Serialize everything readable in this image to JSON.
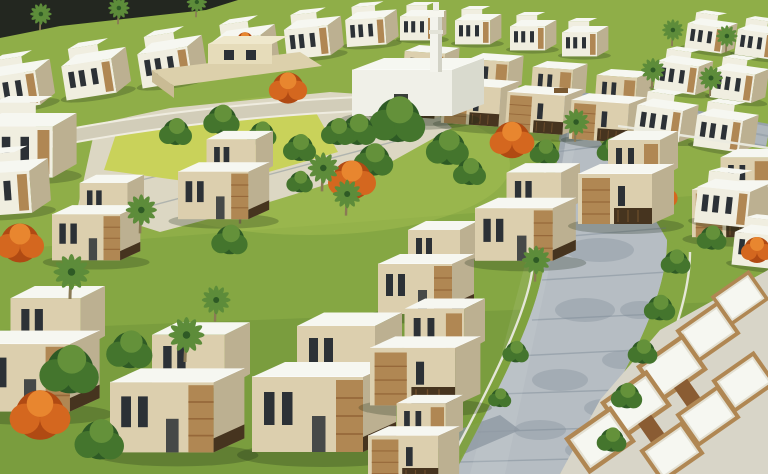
{
  "scene": {
    "type": "aerial architectural rendering",
    "description": "Aerial 3D rendering of a residential villa compound: parallel rows of white and beige flat-roofed villas with tan stone feature walls and dark timber pergolas, a central landscaped park with a yellow-green lawn, paved plaza, palm trees and orange flame trees, a white mosque with a tall minaret, a low clubhouse pavilion, and a curved grey paver street sweeping to the foreground.",
    "landmarks": {
      "mosque": "white mosque with tall minaret beside the central park",
      "clubhouse": "low beige pavilion at the top of the park lawn",
      "park": "central green park with lawn panel and pale paved plaza",
      "main_street": "curved grey paver street from upper right to bottom centre",
      "villa_rows": "receding rows of two-storey villas with white roof slabs"
    },
    "colors": {
      "grass": "#85a743",
      "grass_light": "#a3bd52",
      "lawn_yellow": "#c9d25a",
      "plaza_pale": "#dcd7c3",
      "dark_road": "#232720",
      "tree_dark": "#2e5a25",
      "tree_mid": "#44752d",
      "tree_light": "#64913a",
      "flame_deep": "#b04a13",
      "flame_orange": "#d4671f",
      "flame_light": "#e8862f",
      "palm_green": "#5d8c3a",
      "roof_white": "#f6f7f1",
      "wall_white": "#f0eee0",
      "wall_beige": "#dccfae",
      "wall_shadow": "#bcb091",
      "stone_tan": "#b08753",
      "stone_rust": "#96683a",
      "pergola_brown": "#46341f",
      "window_dark": "#2c3136",
      "street_pavers": "#b6bdc3",
      "street_shadow": "#7c8a95",
      "road_pale": "#d2cdb9"
    }
  }
}
